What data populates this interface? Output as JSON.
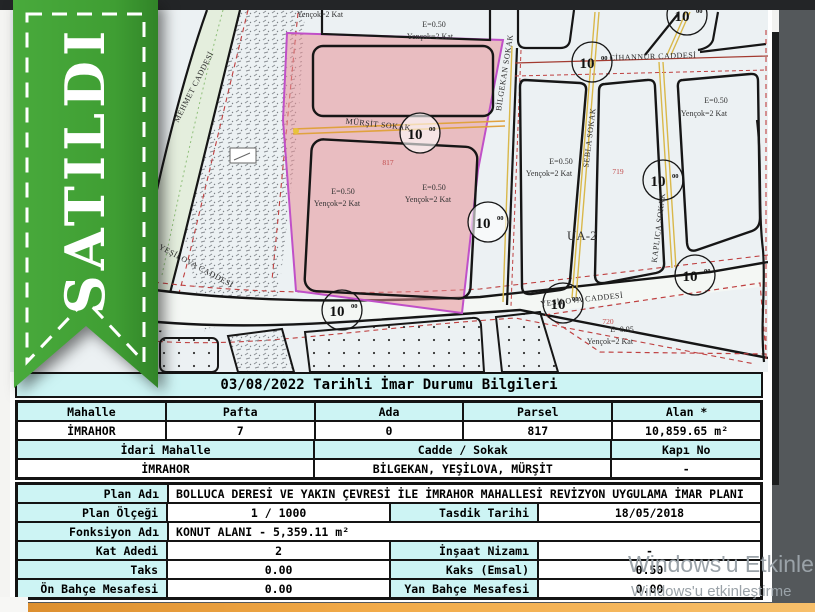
{
  "ribbon": {
    "text": "SATILDI"
  },
  "map": {
    "labels": {
      "mehmet": "MEHMET CADDESİ",
      "yesilova": "YEŞİLOVA CADDESİ",
      "mursit": "MÜRŞİT SOKAK",
      "bilgekan": "BİLGEKAN SOKAK",
      "sebla": "SEBLA SOKAK",
      "kaplica": "KAPLICA SOKAK",
      "cihannur": "CİHANNUR CADDESİ",
      "ua2": "UA-2",
      "e050": "E=0.50",
      "e095": "E=0.95",
      "yencok": "Yençok=2 Kat",
      "p817": "817",
      "p719": "719",
      "p720": "720",
      "dim10": "10",
      "dim10sup": "00"
    }
  },
  "table": {
    "title": "03/08/2022 Tarihli İmar Durumu Bilgileri",
    "parcel": {
      "headers": [
        "Mahalle",
        "Pafta",
        "Ada",
        "Parsel",
        "Alan *"
      ],
      "values": [
        "İMRAHOR",
        "7",
        "0",
        "817",
        "10,859.65 m²"
      ]
    },
    "address": {
      "headers": [
        "İdari Mahalle",
        "Cadde / Sokak",
        "Kapı No"
      ],
      "values": [
        "İMRAHOR",
        "BİLGEKAN, YEŞİLOVA, MÜRŞİT",
        "-"
      ]
    },
    "plan": {
      "plan_adi_label": "Plan Adı",
      "plan_adi": "BOLLUCA DERESİ VE YAKIN ÇEVRESİ İLE İMRAHOR MAHALLESİ REVİZYON UYGULAMA İMAR PLANI",
      "plan_olcegi_label": "Plan Ölçeği",
      "plan_olcegi": "1 / 1000",
      "tasdik_label": "Tasdik Tarihi",
      "tasdik": "18/05/2018",
      "fonksiyon_label": "Fonksiyon Adı",
      "fonksiyon": "KONUT ALANI - 5,359.11 m²",
      "kat_label": "Kat Adedi",
      "kat": "2",
      "nizam_label": "İnşaat Nizamı",
      "nizam": "-",
      "taks_label": "Taks",
      "taks": "0.00",
      "kaks_label": "Kaks (Emsal)",
      "kaks": "0.50",
      "on_bahce_label": "Ön Bahçe Mesafesi",
      "on_bahce": "0.00",
      "yan_bahce_label": "Yan Bahçe Mesafesi",
      "yan_bahce": "0.00"
    }
  },
  "watermark": {
    "line1": "Windows'u Etkinle",
    "line2": "Windows'u etkinleştirme"
  },
  "colors": {
    "ribbon_green": "#3f9e33",
    "parcel_pink": "#f0b6ba",
    "parcel_border": "#c050c8",
    "table_header_cyan": "#cdf4f4",
    "street_orange": "#e0a23e",
    "setback_red": "#bf4040",
    "bottom_bar_orange": "#f2ab49"
  }
}
